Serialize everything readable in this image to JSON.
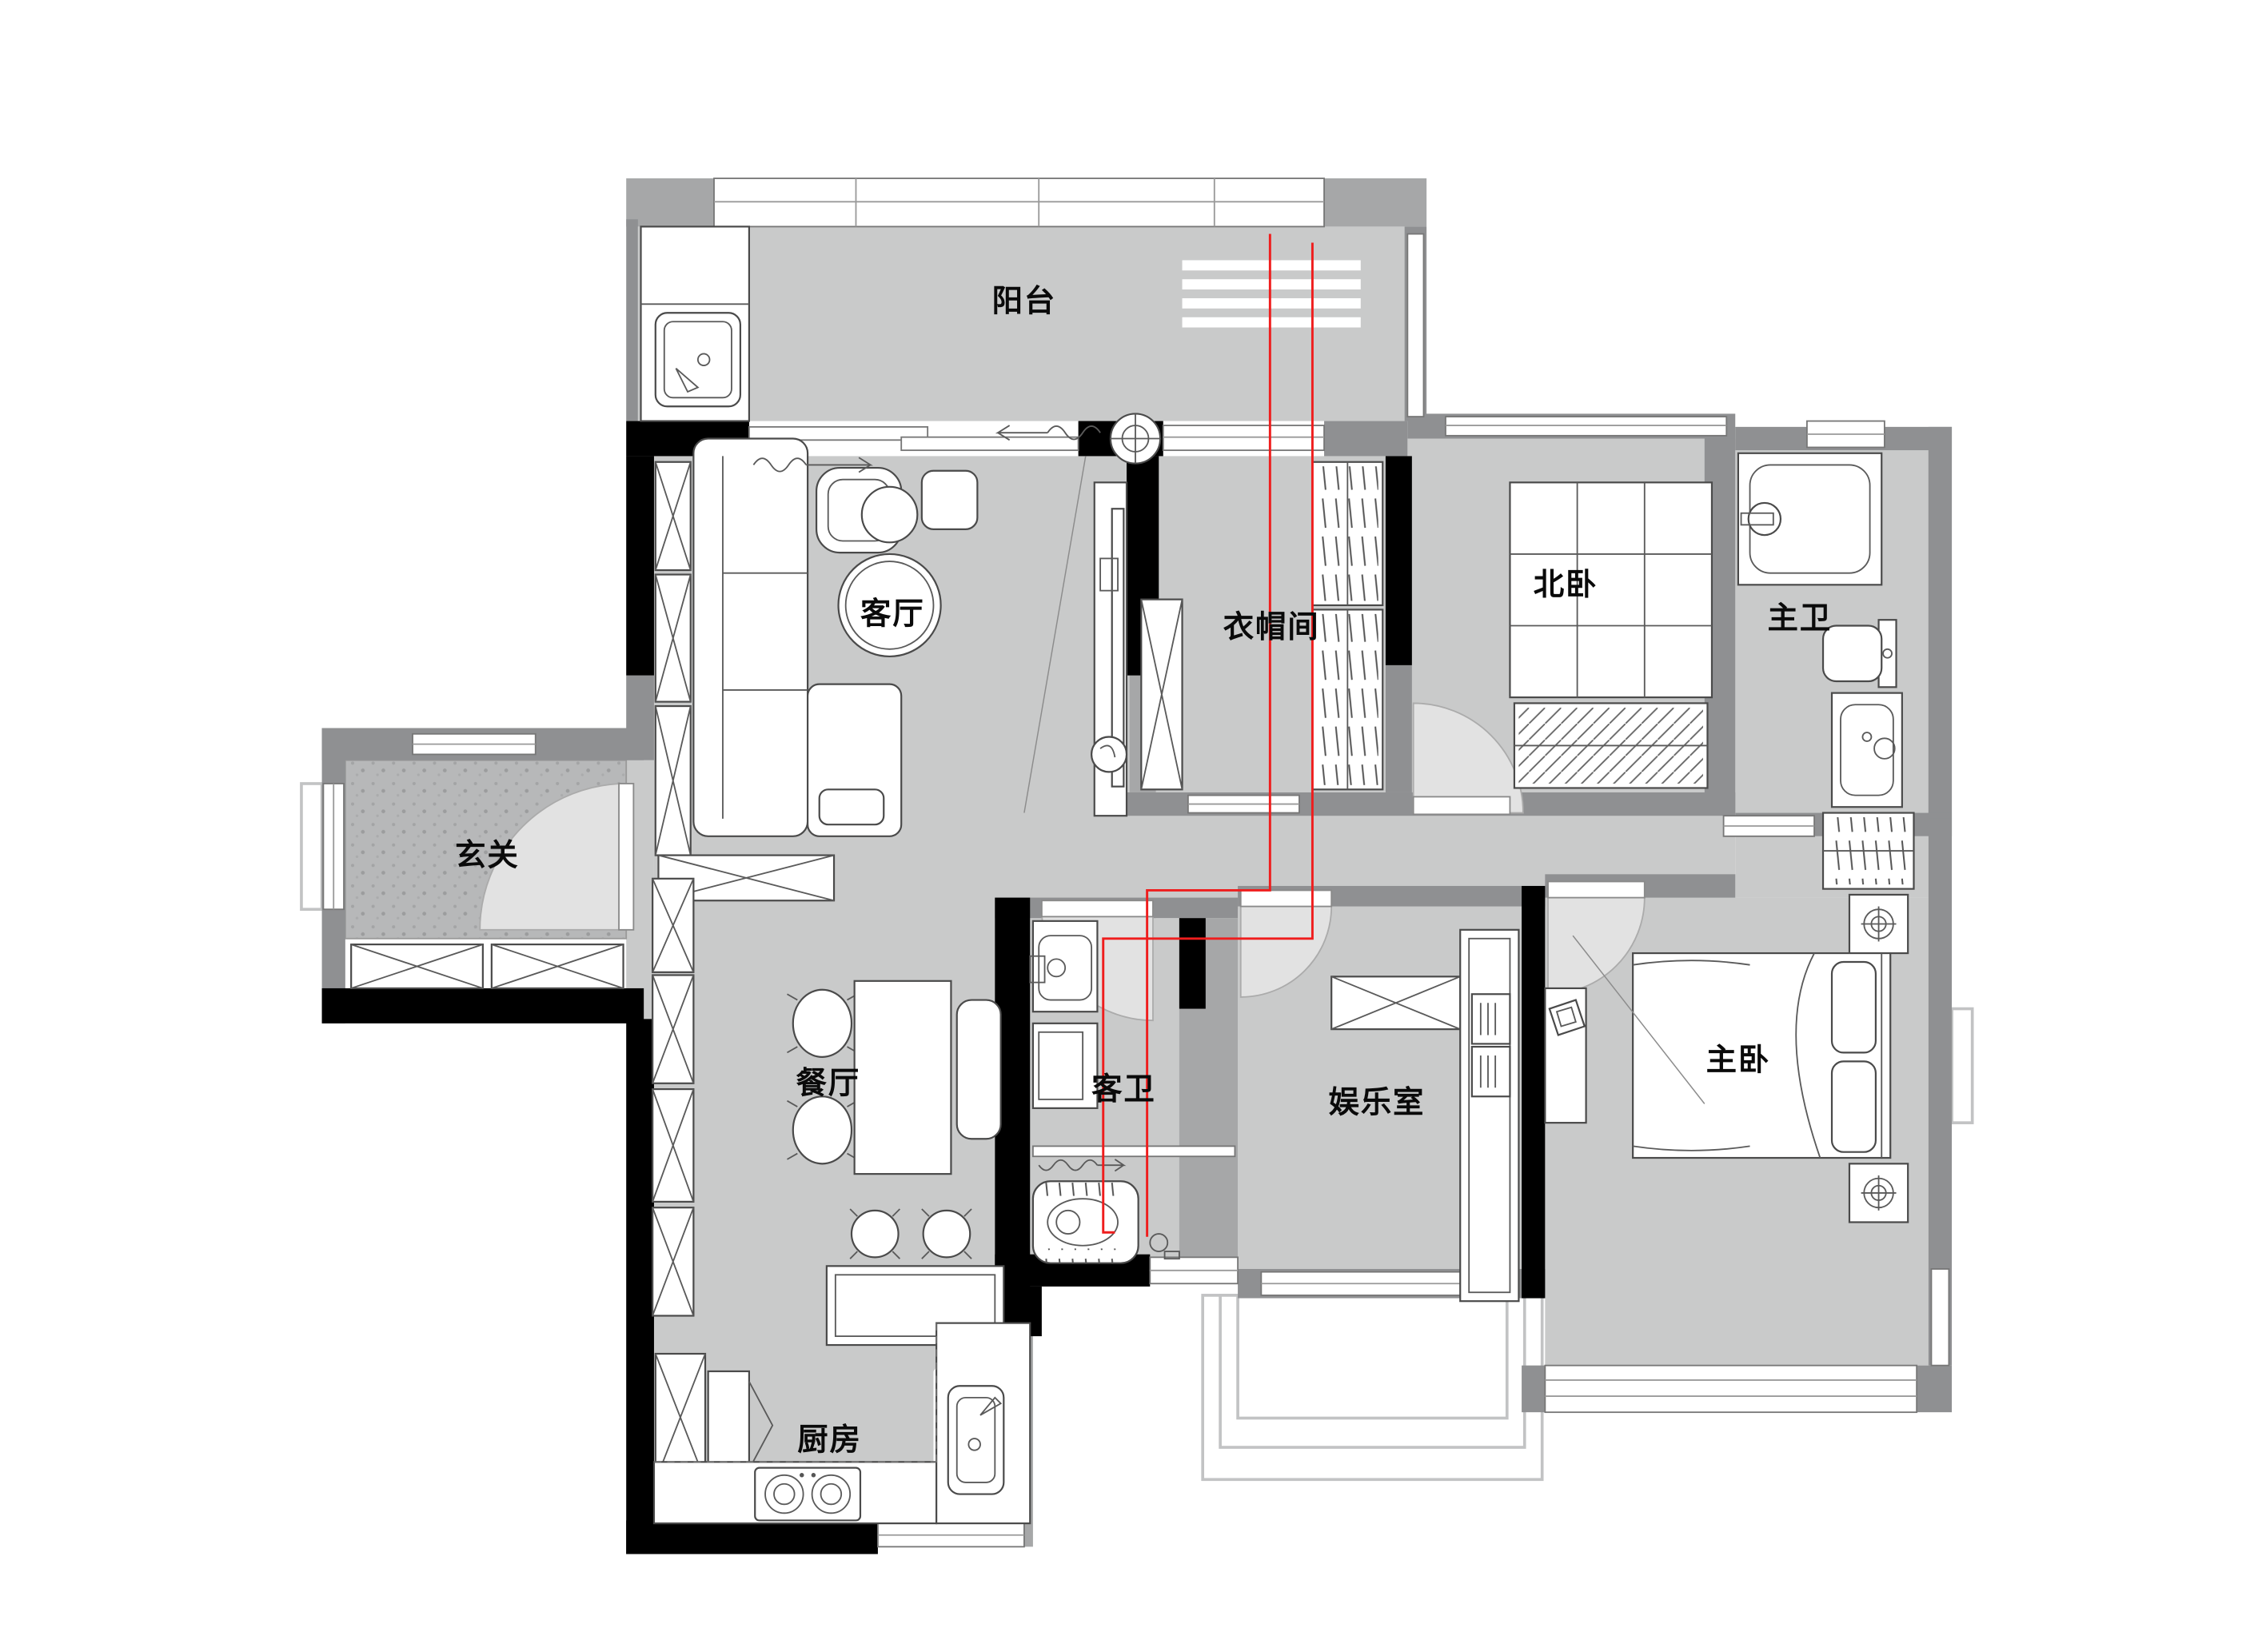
{
  "plan": {
    "type": "apartment-floor-plan",
    "rooms": [
      {
        "id": "balcony",
        "label": "阳台"
      },
      {
        "id": "living-room",
        "label": "客厅"
      },
      {
        "id": "cloakroom",
        "label": "衣帽间"
      },
      {
        "id": "north-bedroom",
        "label": "北卧"
      },
      {
        "id": "master-bathroom",
        "label": "主卫"
      },
      {
        "id": "entryway",
        "label": "玄关"
      },
      {
        "id": "dining-room",
        "label": "餐厅"
      },
      {
        "id": "guest-bathroom",
        "label": "客卫"
      },
      {
        "id": "entertainment-room",
        "label": "娱乐室"
      },
      {
        "id": "master-bedroom",
        "label": "主卧"
      },
      {
        "id": "kitchen",
        "label": "厨房"
      }
    ],
    "colors": {
      "floor": "#c9caca",
      "entry_floor": "#b7b8b9",
      "wall_black": "#000000",
      "wall_gray": "#8f9092",
      "window_white": "#ffffff",
      "door_swing": "#e2e2e2",
      "plumbing_red": "#ef1d1d"
    },
    "symbols": [
      "washing-sink-icon",
      "sliding-door-icon",
      "fan-coil-icon",
      "tv-icon",
      "sofa-icon",
      "armchair-icon",
      "coffee-table-icon",
      "cabinet-x-icon",
      "clothes-rack-icon",
      "tatami-bed-icon",
      "rug-icon",
      "bathtub-icon",
      "toilet-icon",
      "vanity-sink-icon",
      "door-swing-icon",
      "dining-table-icon",
      "chair-icon",
      "bench-icon",
      "stool-icon",
      "island-counter-icon",
      "kitchen-counter-icon",
      "stove-icon",
      "kitchen-sink-icon",
      "fridge-icon",
      "washer-icon",
      "shower-rail-icon",
      "squat-toilet-icon",
      "bookshelf-icon",
      "double-bed-icon",
      "nightstand-lamp-icon",
      "wardrobe-icon",
      "dressing-table-icon",
      "bay-window-icon",
      "plumbing-line-icon"
    ]
  }
}
